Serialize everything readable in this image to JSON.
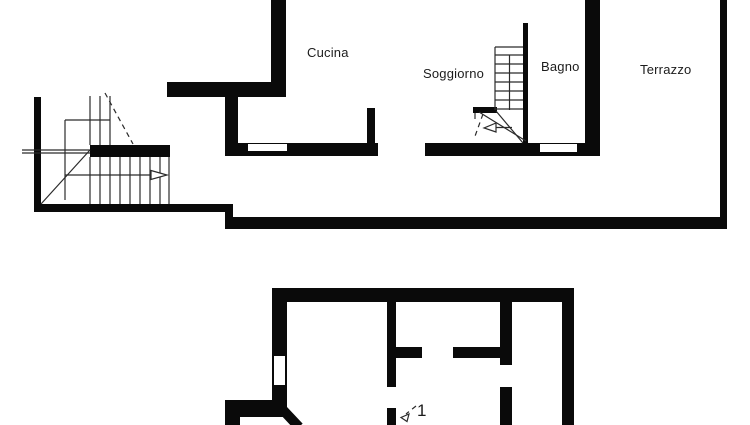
{
  "colors": {
    "wall": "#0a0a0a",
    "line": "#2b2b2b",
    "label": "#1c1c1c",
    "background": "#ffffff"
  },
  "labels": {
    "cucina": "Cucina",
    "soggiorno": "Soggiorno",
    "bagno": "Bagno",
    "terrazzo": "Terrazzo",
    "lower_stair_mark": "1"
  },
  "floorplan": {
    "upper": {
      "walls": [
        {
          "name": "kitchen-left-wall",
          "x": 271,
          "y": 0,
          "w": 15,
          "h": 97
        },
        {
          "name": "kitchen-top-wall",
          "x": 167,
          "y": 82,
          "w": 119,
          "h": 15
        },
        {
          "name": "kitchen-west-wall",
          "x": 225,
          "y": 97,
          "w": 13,
          "h": 59
        },
        {
          "name": "south-wall-left-segment",
          "x": 225,
          "y": 143,
          "w": 153,
          "h": 13
        },
        {
          "name": "kitchen-stub-wall",
          "x": 367,
          "y": 108,
          "w": 8,
          "h": 35
        },
        {
          "name": "south-wall-right-segment",
          "x": 425,
          "y": 143,
          "w": 175,
          "h": 13
        },
        {
          "name": "bagno-terrazzo-wall",
          "x": 585,
          "y": 0,
          "w": 15,
          "h": 156
        },
        {
          "name": "terrazzo-east-wall",
          "x": 720,
          "y": 0,
          "w": 7,
          "h": 229
        },
        {
          "name": "terrazzo-south-wall",
          "x": 225,
          "y": 217,
          "w": 502,
          "h": 12
        },
        {
          "name": "stair-south-wall",
          "x": 36,
          "y": 204,
          "w": 196,
          "h": 8
        },
        {
          "name": "stair-step-connector",
          "x": 225,
          "y": 204,
          "w": 8,
          "h": 25
        },
        {
          "name": "stair-west-wall",
          "x": 34,
          "y": 97,
          "w": 7,
          "h": 115
        },
        {
          "name": "stair-landing-wall",
          "x": 90,
          "y": 145,
          "w": 80,
          "h": 12
        },
        {
          "name": "central-stair-wall",
          "x": 523,
          "y": 23,
          "w": 5,
          "h": 120
        },
        {
          "name": "bagno-stub-wall",
          "x": 473,
          "y": 107,
          "w": 24,
          "h": 6
        }
      ],
      "windows": [
        {
          "name": "window-kitchen",
          "x": 248,
          "y": 144,
          "w": 39,
          "h": 7,
          "frame": false
        },
        {
          "name": "window-bagno",
          "x": 540,
          "y": 144,
          "w": 37,
          "h": 8,
          "frame": false
        }
      ]
    },
    "lower": {
      "walls": [
        {
          "name": "lower-top-wall",
          "x": 272,
          "y": 288,
          "w": 302,
          "h": 14
        },
        {
          "name": "lower-left-wall-upper",
          "x": 272,
          "y": 288,
          "w": 15,
          "h": 68
        },
        {
          "name": "lower-left-wall-lower",
          "x": 272,
          "y": 386,
          "w": 15,
          "h": 31
        },
        {
          "name": "lower-southwest-wall",
          "x": 225,
          "y": 400,
          "w": 62,
          "h": 17
        },
        {
          "name": "lower-southwest-stub",
          "x": 225,
          "y": 400,
          "w": 15,
          "h": 25
        },
        {
          "name": "lower-interior-wall-a-upper",
          "x": 387,
          "y": 302,
          "w": 9,
          "h": 85
        },
        {
          "name": "lower-interior-wall-a-lower",
          "x": 387,
          "y": 408,
          "w": 9,
          "h": 17
        },
        {
          "name": "lower-interior-wall-b-left",
          "x": 392,
          "y": 347,
          "w": 30,
          "h": 11
        },
        {
          "name": "lower-interior-wall-b-right",
          "x": 453,
          "y": 347,
          "w": 47,
          "h": 11
        },
        {
          "name": "lower-interior-wall-c-upper",
          "x": 500,
          "y": 302,
          "w": 12,
          "h": 63
        },
        {
          "name": "lower-interior-wall-c-lower",
          "x": 500,
          "y": 387,
          "w": 12,
          "h": 38
        },
        {
          "name": "lower-right-wall",
          "x": 562,
          "y": 288,
          "w": 12,
          "h": 137
        }
      ],
      "windows": [
        {
          "name": "window-lower-left",
          "x": 272,
          "y": 354,
          "w": 15,
          "h": 33,
          "frame": true
        }
      ],
      "thick_diagonal": {
        "name": "lower-diagonal-wall",
        "x1": 283,
        "y1": 410,
        "x2": 299,
        "y2": 427,
        "width": 10
      }
    },
    "lines": [
      {
        "name": "stair-tread",
        "x1": 90,
        "y1": 157,
        "x2": 90,
        "y2": 204
      },
      {
        "name": "stair-tread",
        "x1": 100,
        "y1": 157,
        "x2": 100,
        "y2": 204
      },
      {
        "name": "stair-tread",
        "x1": 110,
        "y1": 157,
        "x2": 110,
        "y2": 204
      },
      {
        "name": "stair-tread",
        "x1": 120,
        "y1": 157,
        "x2": 120,
        "y2": 204
      },
      {
        "name": "stair-tread",
        "x1": 130,
        "y1": 157,
        "x2": 130,
        "y2": 204
      },
      {
        "name": "stair-tread",
        "x1": 140,
        "y1": 157,
        "x2": 140,
        "y2": 204
      },
      {
        "name": "stair-tread",
        "x1": 150,
        "y1": 157,
        "x2": 150,
        "y2": 204
      },
      {
        "name": "stair-tread",
        "x1": 160,
        "y1": 157,
        "x2": 160,
        "y2": 204
      },
      {
        "name": "stair-tread",
        "x1": 169,
        "y1": 157,
        "x2": 169,
        "y2": 204
      },
      {
        "name": "stair-riser",
        "x1": 90,
        "y1": 96,
        "x2": 90,
        "y2": 145
      },
      {
        "name": "stair-riser",
        "x1": 100,
        "y1": 96,
        "x2": 100,
        "y2": 145
      },
      {
        "name": "stair-riser",
        "x1": 110,
        "y1": 96,
        "x2": 110,
        "y2": 145
      },
      {
        "name": "stair-outline",
        "x1": 65,
        "y1": 120,
        "x2": 110,
        "y2": 120
      },
      {
        "name": "stair-outline",
        "x1": 65,
        "y1": 120,
        "x2": 65,
        "y2": 200
      },
      {
        "name": "stair-ledge",
        "x1": 22,
        "y1": 150,
        "x2": 90,
        "y2": 150
      },
      {
        "name": "stair-ledge",
        "x1": 22,
        "y1": 153,
        "x2": 90,
        "y2": 153
      },
      {
        "name": "stair-diagonal",
        "x1": 41,
        "y1": 204,
        "x2": 90,
        "y2": 150
      },
      {
        "name": "stair-arrow-shaft",
        "x1": 65,
        "y1": 175,
        "x2": 151,
        "y2": 175
      },
      {
        "name": "central-stair-side",
        "x1": 495,
        "y1": 47,
        "x2": 495,
        "y2": 110
      },
      {
        "name": "central-stair-center",
        "x1": 509.5,
        "y1": 55,
        "x2": 509.5,
        "y2": 110
      },
      {
        "name": "central-stair-top",
        "x1": 495,
        "y1": 47,
        "x2": 523,
        "y2": 47
      },
      {
        "name": "central-stair-tread",
        "x1": 495,
        "y1": 55,
        "x2": 523,
        "y2": 55
      },
      {
        "name": "central-stair-tread",
        "x1": 495,
        "y1": 64,
        "x2": 523,
        "y2": 64
      },
      {
        "name": "central-stair-tread",
        "x1": 495,
        "y1": 73,
        "x2": 523,
        "y2": 73
      },
      {
        "name": "central-stair-tread",
        "x1": 495,
        "y1": 82,
        "x2": 523,
        "y2": 82
      },
      {
        "name": "central-stair-tread",
        "x1": 495,
        "y1": 91,
        "x2": 523,
        "y2": 91
      },
      {
        "name": "central-stair-tread",
        "x1": 495,
        "y1": 100,
        "x2": 523,
        "y2": 100
      },
      {
        "name": "central-stair-tread",
        "x1": 495,
        "y1": 109,
        "x2": 523,
        "y2": 109
      },
      {
        "name": "central-stair-diagonal",
        "x1": 526,
        "y1": 141,
        "x2": 479,
        "y2": 112
      },
      {
        "name": "central-stair-diagonal",
        "x1": 523,
        "y1": 143,
        "x2": 496,
        "y2": 111
      },
      {
        "name": "central-stair-arrow-shaft",
        "x1": 512,
        "y1": 127.5,
        "x2": 495,
        "y2": 127.5
      },
      {
        "name": "central-stair-tick",
        "x1": 475,
        "y1": 113,
        "x2": 475,
        "y2": 119
      }
    ],
    "dashed_lines": [
      {
        "name": "stair-section-cut",
        "x1": 105,
        "y1": 93,
        "x2": 133,
        "y2": 144
      },
      {
        "name": "central-stair-section-cut",
        "x1": 483,
        "y1": 114,
        "x2": 474,
        "y2": 139
      },
      {
        "name": "lower-stair-arrow-shaft",
        "x1": 416,
        "y1": 406,
        "x2": 406,
        "y2": 414
      }
    ],
    "arrowheads": [
      {
        "name": "stair-up-arrowhead",
        "points": "151,170.5 167,175 151,179.5"
      },
      {
        "name": "central-stair-arrowhead",
        "points": "496,123 484,128 496,132"
      },
      {
        "name": "lower-stair-arrowhead",
        "points": "409,414 401,417.5 407,421.5"
      }
    ]
  }
}
